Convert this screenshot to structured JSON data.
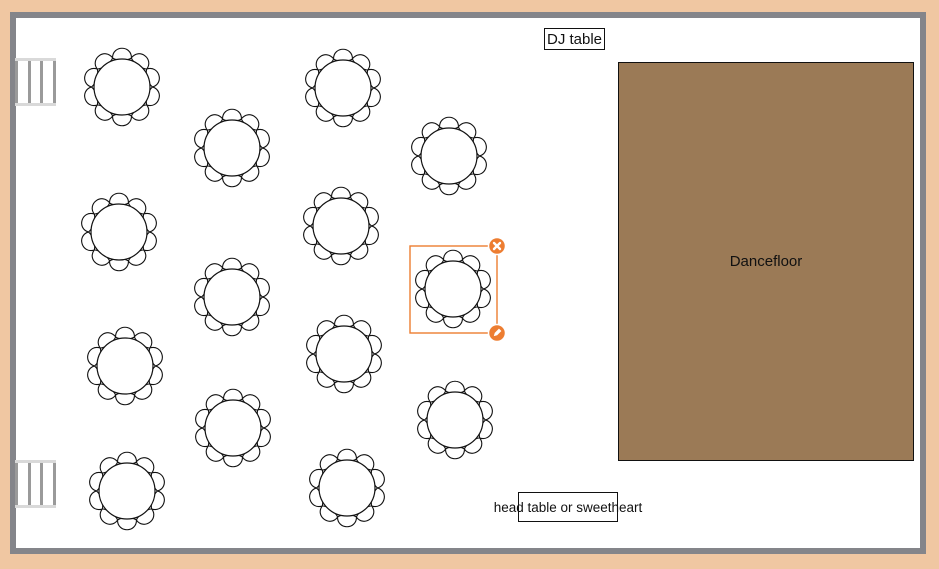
{
  "app": {
    "type": "banquet-floor-plan-editor"
  },
  "colors": {
    "page_background": "#f0c7a2",
    "wall": "#84858a",
    "room_fill": "#ffffff",
    "dancefloor_fill": "#9b7a56",
    "selection_accent": "#ED7D31",
    "table_outline": "#111111"
  },
  "shapes": {
    "dj_table": {
      "label": "DJ table"
    },
    "dancefloor": {
      "label": "Dancefloor"
    },
    "head_table": {
      "label": "head table or sweetheart"
    }
  },
  "doors": [
    {
      "id": "door-top",
      "x": 15,
      "y": 58
    },
    {
      "id": "door-bottom",
      "x": 15,
      "y": 460
    }
  ],
  "tables": [
    {
      "id": "table-1",
      "x": 122,
      "y": 87,
      "seats": 10,
      "selected": false
    },
    {
      "id": "table-2",
      "x": 232,
      "y": 148,
      "seats": 10,
      "selected": false
    },
    {
      "id": "table-3",
      "x": 343,
      "y": 88,
      "seats": 10,
      "selected": false
    },
    {
      "id": "table-4",
      "x": 449,
      "y": 156,
      "seats": 10,
      "selected": false
    },
    {
      "id": "table-5",
      "x": 119,
      "y": 232,
      "seats": 10,
      "selected": false
    },
    {
      "id": "table-6",
      "x": 232,
      "y": 297,
      "seats": 10,
      "selected": false
    },
    {
      "id": "table-7",
      "x": 341,
      "y": 226,
      "seats": 10,
      "selected": false
    },
    {
      "id": "table-8",
      "x": 453,
      "y": 289,
      "seats": 10,
      "selected": true
    },
    {
      "id": "table-9",
      "x": 125,
      "y": 366,
      "seats": 10,
      "selected": false
    },
    {
      "id": "table-10",
      "x": 233,
      "y": 428,
      "seats": 10,
      "selected": false
    },
    {
      "id": "table-11",
      "x": 344,
      "y": 354,
      "seats": 10,
      "selected": false
    },
    {
      "id": "table-12",
      "x": 455,
      "y": 420,
      "seats": 10,
      "selected": false
    },
    {
      "id": "table-13",
      "x": 127,
      "y": 491,
      "seats": 10,
      "selected": false
    },
    {
      "id": "table-14",
      "x": 347,
      "y": 488,
      "seats": 10,
      "selected": false
    }
  ],
  "selection": {
    "target": "table-8",
    "x": 410,
    "y": 246,
    "width": 87,
    "height": 87,
    "handles": [
      {
        "id": "delete-handle",
        "icon": "x-icon",
        "corner": "top-right"
      },
      {
        "id": "edit-handle",
        "icon": "pencil-icon",
        "corner": "bottom-right"
      }
    ]
  }
}
